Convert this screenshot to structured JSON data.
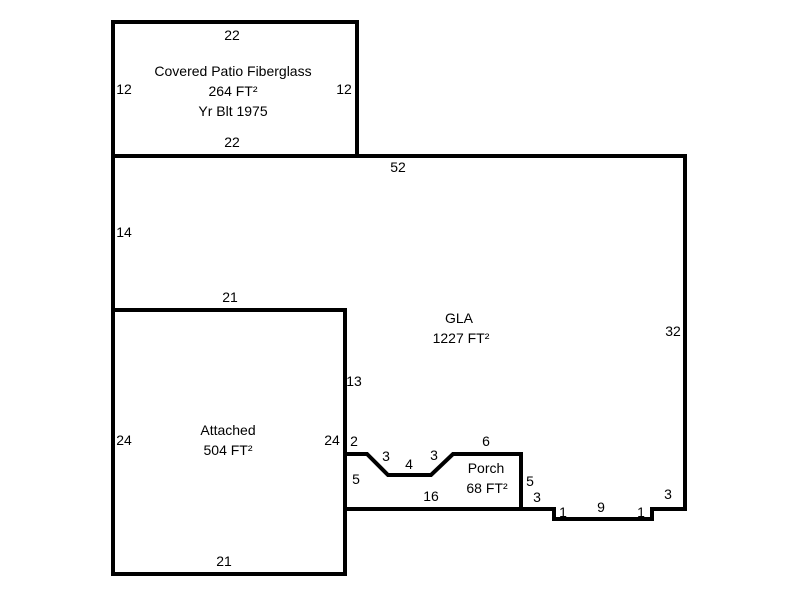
{
  "sketch": {
    "type": "floor-plan",
    "background_color": "#ffffff",
    "outline_color": "#000000",
    "text_color": "#000000"
  },
  "areas": {
    "covered_patio": {
      "lines": [
        "Covered Patio Fiberglass",
        "264 FT²",
        "Yr Blt 1975"
      ],
      "area_sqft": 264,
      "year_built": 1975
    },
    "gla": {
      "lines": [
        "GLA",
        "1227 FT²"
      ],
      "area_sqft": 1227
    },
    "attached": {
      "lines": [
        "Attached",
        "504 FT²"
      ],
      "area_sqft": 504
    },
    "porch": {
      "lines": [
        "Porch",
        "68 FT²"
      ],
      "area_sqft": 68
    }
  },
  "dimensions": [
    {
      "text": "22",
      "x": 232,
      "y": 35
    },
    {
      "text": "12",
      "x": 124,
      "y": 89
    },
    {
      "text": "12",
      "x": 344,
      "y": 89
    },
    {
      "text": "22",
      "x": 232,
      "y": 142
    },
    {
      "text": "52",
      "x": 398,
      "y": 167
    },
    {
      "text": "14",
      "x": 124,
      "y": 232
    },
    {
      "text": "21",
      "x": 230,
      "y": 297
    },
    {
      "text": "32",
      "x": 673,
      "y": 331
    },
    {
      "text": "13",
      "x": 354,
      "y": 381
    },
    {
      "text": "24",
      "x": 124,
      "y": 440
    },
    {
      "text": "24",
      "x": 332,
      "y": 440
    },
    {
      "text": "2",
      "x": 354,
      "y": 441
    },
    {
      "text": "3",
      "x": 386,
      "y": 456
    },
    {
      "text": "4",
      "x": 409,
      "y": 464
    },
    {
      "text": "3",
      "x": 434,
      "y": 455
    },
    {
      "text": "6",
      "x": 486,
      "y": 441
    },
    {
      "text": "5",
      "x": 356,
      "y": 479
    },
    {
      "text": "16",
      "x": 431,
      "y": 496
    },
    {
      "text": "5",
      "x": 530,
      "y": 481
    },
    {
      "text": "3",
      "x": 537,
      "y": 497
    },
    {
      "text": "21",
      "x": 224,
      "y": 561
    },
    {
      "text": "1",
      "x": 563,
      "y": 512
    },
    {
      "text": "9",
      "x": 601,
      "y": 507
    },
    {
      "text": "1",
      "x": 641,
      "y": 512
    },
    {
      "text": "3",
      "x": 668,
      "y": 494
    }
  ]
}
